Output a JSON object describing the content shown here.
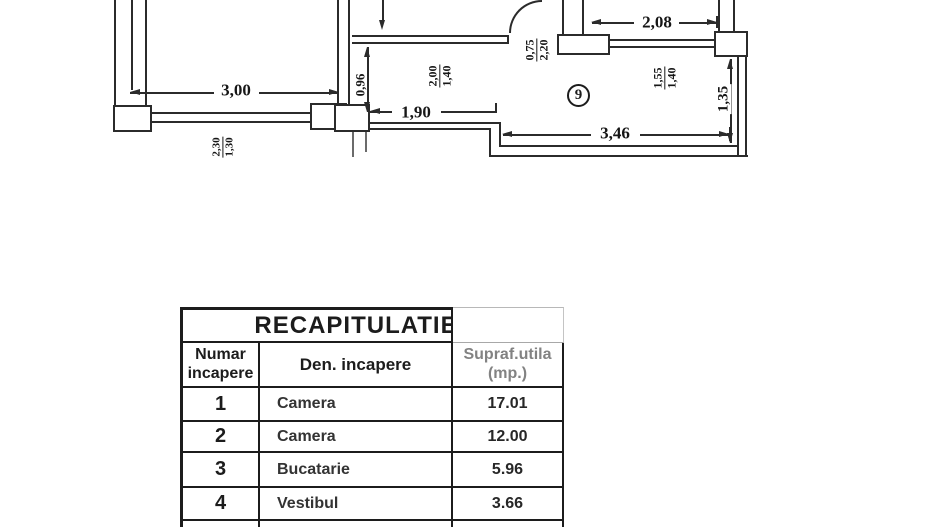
{
  "colors": {
    "ink": "#1c1c1c",
    "faded_header": "#828282"
  },
  "plan": {
    "room_circle": "9",
    "dim_300": "3,00",
    "dim_190": "1,90",
    "dim_208": "2,08",
    "dim_346": "3,46",
    "dim_096": "0,96",
    "dim_135": "1,35",
    "frac_230_130": {
      "top": "2,30",
      "bot": "1,30"
    },
    "frac_200_140": {
      "top": "2,00",
      "bot": "1,40"
    },
    "frac_075_220": {
      "top": "0,75",
      "bot": "2,20"
    },
    "frac_155_140": {
      "top": "1,55",
      "bot": "1,40"
    }
  },
  "table": {
    "title": "RECAPITULATIE",
    "header": {
      "col1_line1": "Numar",
      "col1_line2": "incapere",
      "col2": "Den. incapere",
      "col3_line1": "Supraf.utila",
      "col3_line2": "(mp.)"
    },
    "rows": [
      {
        "nr": "1",
        "name": "Camera",
        "area": "17.01"
      },
      {
        "nr": "2",
        "name": "Camera",
        "area": "12.00"
      },
      {
        "nr": "3",
        "name": "Bucatarie",
        "area": "5.96"
      },
      {
        "nr": "4",
        "name": "Vestibul",
        "area": "3.66"
      }
    ]
  }
}
